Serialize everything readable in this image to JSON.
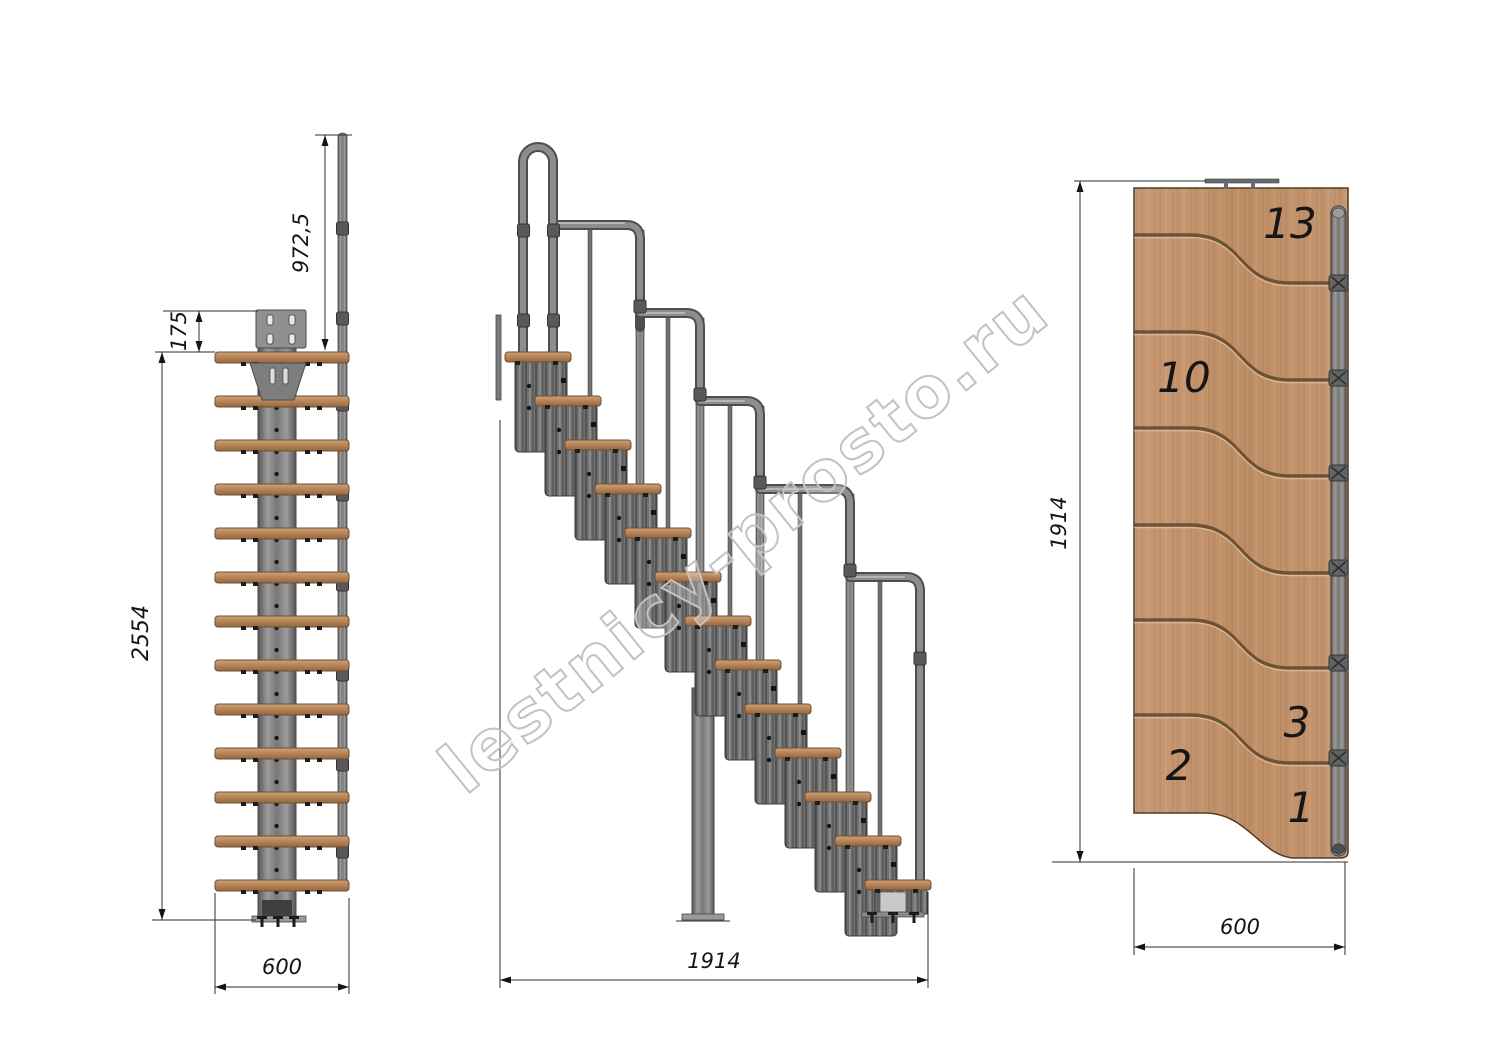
{
  "watermark": {
    "text": "lestnicy-prosto.ru",
    "outline_color": "#c2c2c2"
  },
  "views": {
    "front": {
      "dims": {
        "rail_height": "972,5",
        "plate_offset": "175",
        "total_height": "2554",
        "width": "600"
      }
    },
    "side": {
      "dims": {
        "total_run": "1914"
      }
    },
    "plan": {
      "dims": {
        "length": "1914",
        "width": "600"
      },
      "tread_labels": [
        "13",
        "10",
        "3",
        "2",
        "1"
      ]
    }
  },
  "colors": {
    "wood": "#bf8e66",
    "wood_edge": "#6e4f32",
    "steel": "#7a7a7a",
    "steel_dark": "#4e4e4e",
    "dimension_lines": "#141414"
  }
}
